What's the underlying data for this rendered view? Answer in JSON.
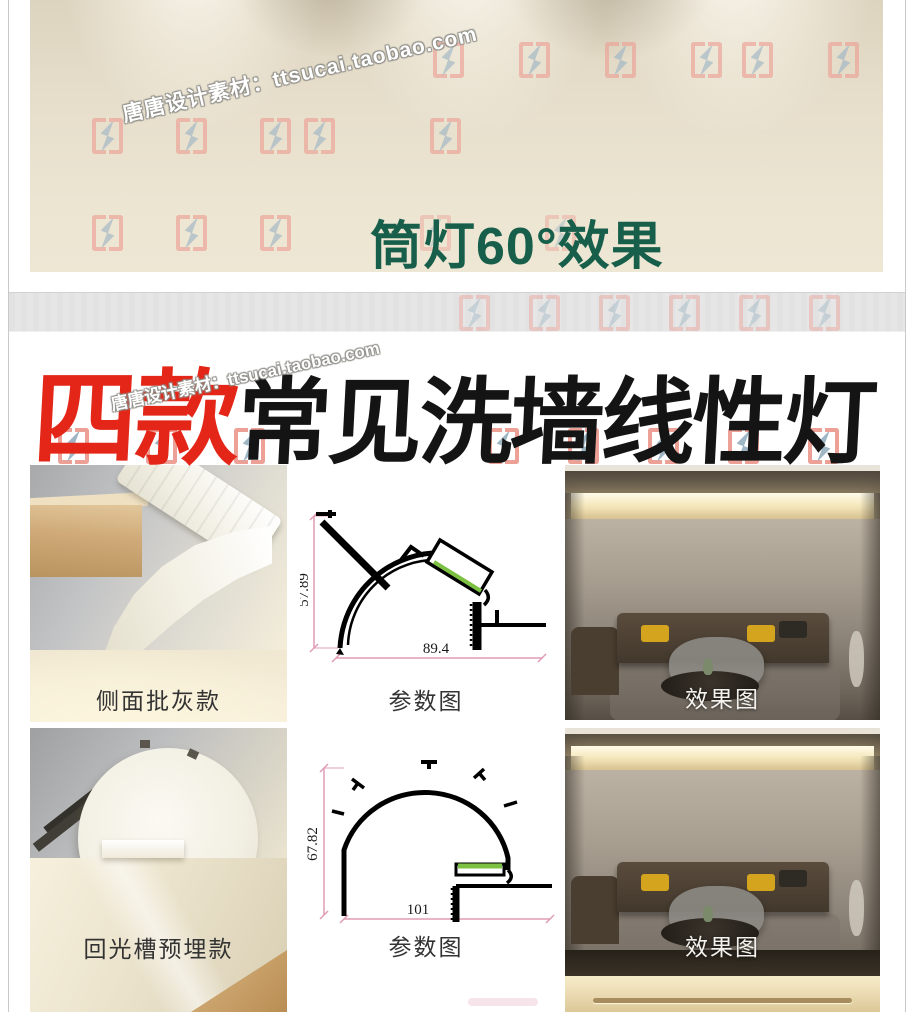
{
  "page": {
    "watermark_text": "唐唐设计素材：ttsucai.taobao.com"
  },
  "top_banner": {
    "caption": "筒灯60°效果"
  },
  "headline": {
    "highlight": "四款",
    "rest": "常见洗墙线性灯"
  },
  "grid": {
    "rows": [
      {
        "product_label": "侧面批灰款",
        "diagram_label": "参数图",
        "effect_label": "效果图",
        "dims": {
          "height": "57.89",
          "width": "89.4"
        }
      },
      {
        "product_label": "回光槽预埋款",
        "diagram_label": "参数图",
        "effect_label": "效果图",
        "dims": {
          "height": "67.82",
          "width": "101"
        }
      }
    ]
  },
  "colors": {
    "caption_green": "#175f4b",
    "headline_red": "#e32617",
    "headline_black": "#141414",
    "dimension_pink": "#e09cb5",
    "led_green": "#7cc142",
    "logo_bracket_red": "#eda196",
    "logo_bolt_blue": "#9fb6c5"
  }
}
